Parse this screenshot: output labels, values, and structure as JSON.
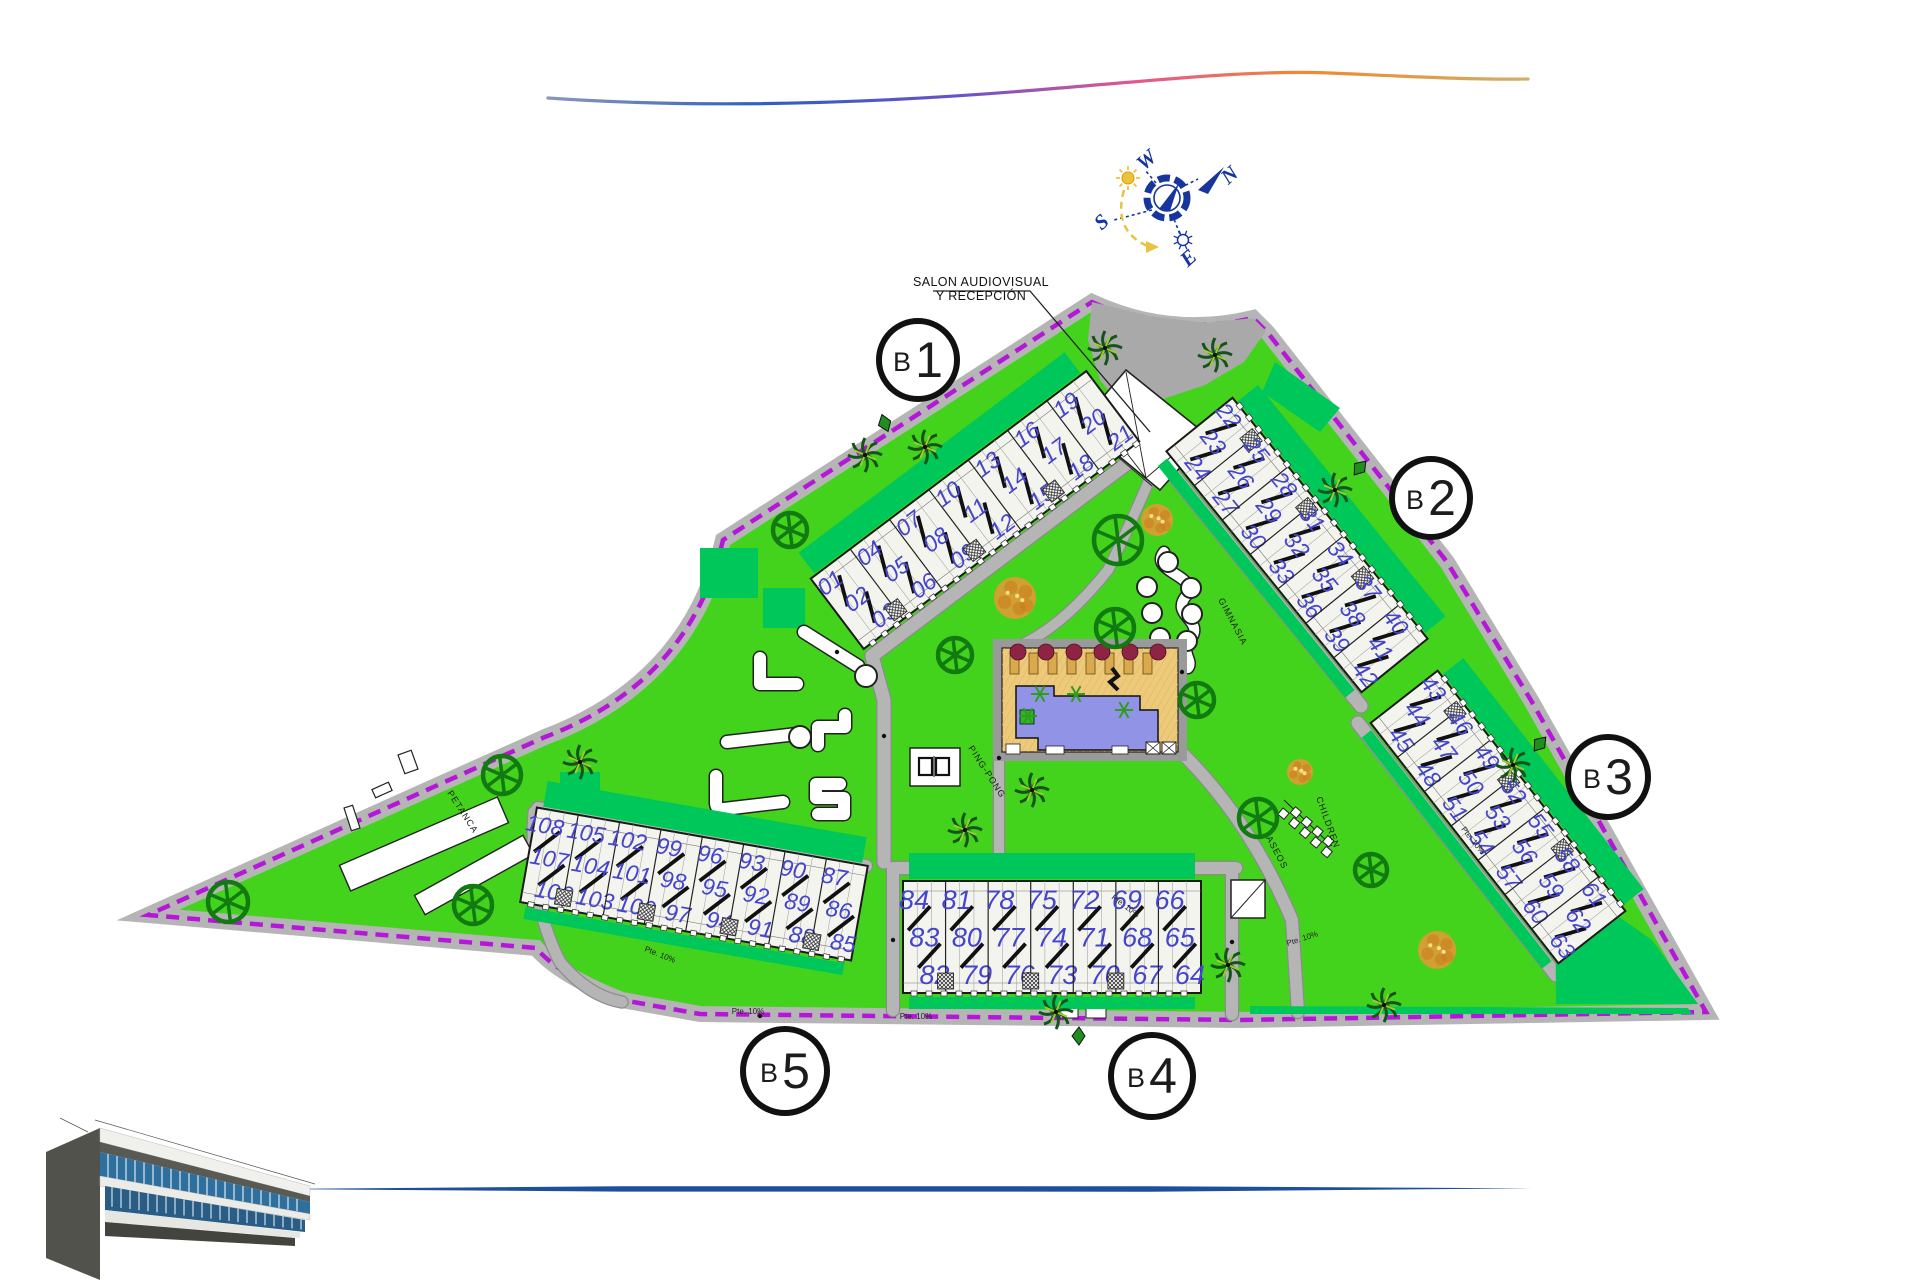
{
  "page": {
    "width": 1920,
    "height": 1280,
    "background": "#ffffff"
  },
  "branding": {
    "swoosh_colors": [
      "#8898b8",
      "#2f5fc0",
      "#6a52c8",
      "#e25890",
      "#f08a30",
      "#cfae6a"
    ],
    "bottom_line_color": "#1d4f9c"
  },
  "compass": {
    "labels": {
      "west": "W",
      "north": "N",
      "south": "S",
      "east": "E"
    },
    "colors": {
      "main": "#16369e",
      "sun": "#eec33c"
    }
  },
  "note": {
    "line1": "SALON AUDIOVISUAL",
    "line2": "Y RECEPCIÓN"
  },
  "amenities": {
    "petanca": "PETANCA",
    "gimnasia": "GIMNASIA",
    "ping_pong": "PING-PONG",
    "children": "CHILDREN",
    "aseos": "ASEOS"
  },
  "ramp_label": "Pte. 10%",
  "ramp_positions": [
    [
      748,
      1014,
      0
    ],
    [
      916,
      1019,
      0
    ],
    [
      1124,
      908,
      37
    ],
    [
      1303,
      941,
      -18
    ],
    [
      659,
      957,
      22
    ],
    [
      1471,
      842,
      52
    ]
  ],
  "site": {
    "colors": {
      "lawn": "#44d31c",
      "garden": "#00c759",
      "path": "#b5b5b5",
      "path_edge": "#8c8c8c",
      "plaza": "#a9a9a9",
      "boundary": "#b517d8",
      "building_fill": "#f4f4ef",
      "building_edge": "#1a1a1a",
      "unit_number": "#4444cc",
      "pool_water": "#9093e6",
      "pool_deck": "#edca79",
      "tree": "#117a11",
      "autumn_tree": "#e09a35",
      "palm_dark": "#14531a",
      "palm_light": "#9ccd2e",
      "umbrella": "#8e2343"
    }
  },
  "blocks": [
    {
      "id": "b1",
      "label": "B1",
      "circle": {
        "x": 918,
        "y": 360,
        "r": 39
      },
      "bar": {
        "cx": 975,
        "cy": 510,
        "angle": -37,
        "length": 345,
        "depth": 88
      },
      "ticks_side": 1,
      "stair": "steep",
      "num_size": 23,
      "garden_sides": [
        -1
      ],
      "unit_groups": [
        [
          "01",
          "02",
          "03"
        ],
        [
          "04",
          "05",
          "06"
        ],
        [
          "07",
          "08",
          "09"
        ],
        [
          "10",
          "11",
          "12"
        ],
        [
          "13",
          "14",
          "15"
        ],
        [
          "16",
          "17",
          "18"
        ],
        [
          "19",
          "20",
          "21"
        ]
      ]
    },
    {
      "id": "b2",
      "label": "B2",
      "circle": {
        "x": 1431,
        "y": 498,
        "r": 39
      },
      "bar": {
        "cx": 1297,
        "cy": 545,
        "angle": 51,
        "length": 310,
        "depth": 85
      },
      "ticks_side": -1,
      "stair": "steep",
      "num_size": 23,
      "garden_sides": [
        -1,
        1
      ],
      "unit_groups": [
        [
          "22",
          "23",
          "24"
        ],
        [
          "25",
          "26",
          "27"
        ],
        [
          "28",
          "29",
          "30"
        ],
        [
          "31",
          "32",
          "33"
        ],
        [
          "34",
          "35",
          "36"
        ],
        [
          "37",
          "38",
          "39"
        ],
        [
          "40",
          "41",
          "42"
        ]
      ]
    },
    {
      "id": "b3",
      "label": "B3",
      "circle": {
        "x": 1608,
        "y": 777,
        "r": 40
      },
      "bar": {
        "cx": 1498,
        "cy": 817,
        "angle": 52,
        "length": 305,
        "depth": 85
      },
      "ticks_side": -1,
      "stair": "steep",
      "num_size": 23,
      "garden_sides": [
        -1,
        1
      ],
      "unit_groups": [
        [
          "43",
          "44",
          "45"
        ],
        [
          "46",
          "47",
          "48"
        ],
        [
          "49",
          "50",
          "51"
        ],
        [
          "52",
          "53",
          "54"
        ],
        [
          "55",
          "56",
          "57"
        ],
        [
          "58",
          "59",
          "60"
        ],
        [
          "61",
          "62",
          "63"
        ]
      ]
    },
    {
      "id": "b4",
      "label": "B4",
      "circle": {
        "x": 1152,
        "y": 1076,
        "r": 41
      },
      "bar": {
        "cx": 1052,
        "cy": 937,
        "angle": 0,
        "length": 298,
        "depth": 112
      },
      "ticks_side": 1,
      "stair": "slash",
      "num_size": 27,
      "garden_sides": [
        -1,
        1
      ],
      "unit_groups": [
        [
          "84",
          "83",
          "82"
        ],
        [
          "81",
          "80",
          "79"
        ],
        [
          "78",
          "77",
          "76"
        ],
        [
          "75",
          "74",
          "73"
        ],
        [
          "72",
          "71",
          "70"
        ],
        [
          "69",
          "68",
          "67"
        ],
        [
          "66",
          "65",
          "64"
        ]
      ]
    },
    {
      "id": "b5",
      "label": "B5",
      "circle": {
        "x": 785,
        "y": 1071,
        "r": 42
      },
      "bar": {
        "cx": 694,
        "cy": 884,
        "angle": 10,
        "length": 336,
        "depth": 96
      },
      "ticks_side": 1,
      "stair": "slash",
      "num_size": 23,
      "garden_sides": [
        -1,
        1
      ],
      "unit_groups": [
        [
          "108",
          "107",
          "106"
        ],
        [
          "105",
          "104",
          "103"
        ],
        [
          "102",
          "101",
          "100"
        ],
        [
          "99",
          "98",
          "97"
        ],
        [
          "96",
          "95",
          "94"
        ],
        [
          "93",
          "92",
          "91"
        ],
        [
          "90",
          "89",
          "88"
        ],
        [
          "87",
          "86",
          "85"
        ]
      ]
    }
  ],
  "trees": {
    "round": [
      [
        228,
        902,
        20
      ],
      [
        473,
        905,
        19
      ],
      [
        502,
        775,
        19
      ],
      [
        955,
        655,
        17
      ],
      [
        1118,
        540,
        24
      ],
      [
        1115,
        628,
        19
      ],
      [
        1197,
        700,
        17
      ],
      [
        1258,
        818,
        19
      ],
      [
        1371,
        870,
        16
      ],
      [
        790,
        530,
        17
      ]
    ],
    "autumn": [
      [
        1015,
        598,
        21
      ],
      [
        1157,
        520,
        16
      ],
      [
        1437,
        950,
        19
      ],
      [
        1300,
        772,
        13
      ]
    ],
    "palms": [
      [
        580,
        762
      ],
      [
        965,
        830
      ],
      [
        1032,
        790
      ],
      [
        1228,
        965
      ],
      [
        1105,
        348
      ],
      [
        1215,
        355
      ],
      [
        1335,
        490
      ],
      [
        1513,
        765
      ],
      [
        1056,
        1012
      ],
      [
        1384,
        1005
      ],
      [
        865,
        455
      ],
      [
        925,
        447
      ]
    ]
  },
  "markers": [
    [
      885,
      423,
      -20
    ],
    [
      1360,
      468,
      40
    ],
    [
      1540,
      744,
      40
    ],
    [
      1079,
      1036,
      0
    ]
  ]
}
